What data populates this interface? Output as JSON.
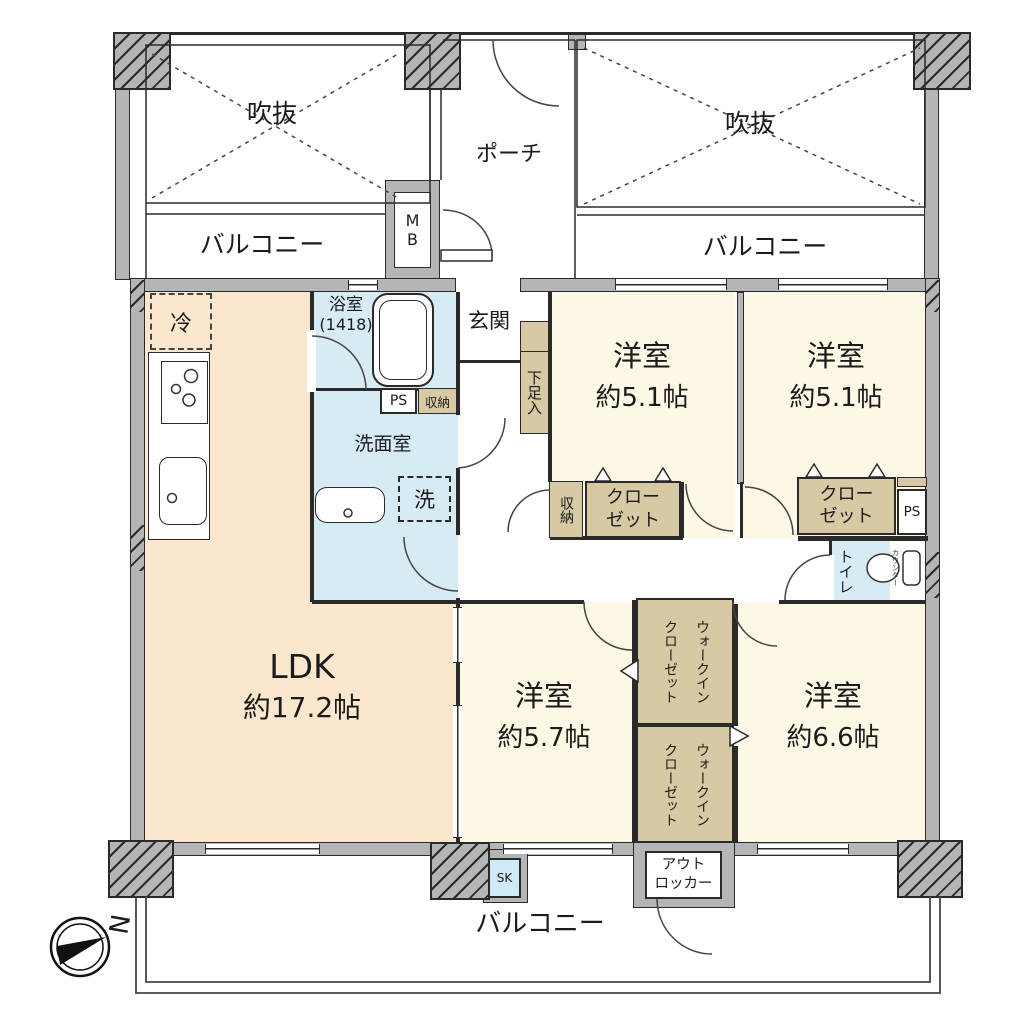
{
  "colors": {
    "wall_gray": "#b4b5b7",
    "room_cream": "#fcf8e5",
    "ldk_peach": "#fbe6ce",
    "wet_blue": "#d7ebf5",
    "closet_tan": "#d7c9a3",
    "line": "#2a2a2a"
  },
  "compass": {
    "north_label": "N"
  },
  "outdoor": {
    "void_left": "吹抜",
    "void_right": "吹抜",
    "porch": "ポーチ",
    "balcony_top_left": "バルコニー",
    "balcony_top_right": "バルコニー",
    "balcony_bottom": "バルコニー",
    "meter_box": "MB",
    "out_locker_line1": "アウト",
    "out_locker_line2": "ロッカー",
    "slop_sink": "SK"
  },
  "rooms": {
    "ldk": {
      "name": "LDK",
      "size": "約17.2帖"
    },
    "bedroom1": {
      "name": "洋室",
      "size": "約5.1帖"
    },
    "bedroom2": {
      "name": "洋室",
      "size": "約5.1帖"
    },
    "bedroom3": {
      "name": "洋室",
      "size": "約5.7帖"
    },
    "bedroom4": {
      "name": "洋室",
      "size": "約6.6帖"
    },
    "bath": {
      "name": "浴室",
      "size": "(1418)"
    },
    "washroom": "洗面室",
    "toilet": "トイレ",
    "entrance": "玄関"
  },
  "fixtures": {
    "fridge": "冷",
    "washer": "洗",
    "shoe_cabinet": "下足入",
    "toilet_counter": "カウンター"
  },
  "storage": {
    "hall_storage": "収納",
    "bedroom1_storage": "収納",
    "closet_line1": "クロー",
    "closet_line2": "ゼット",
    "wic_line1": "ウォークイン",
    "wic_line2": "クローゼット",
    "ps": "PS"
  }
}
